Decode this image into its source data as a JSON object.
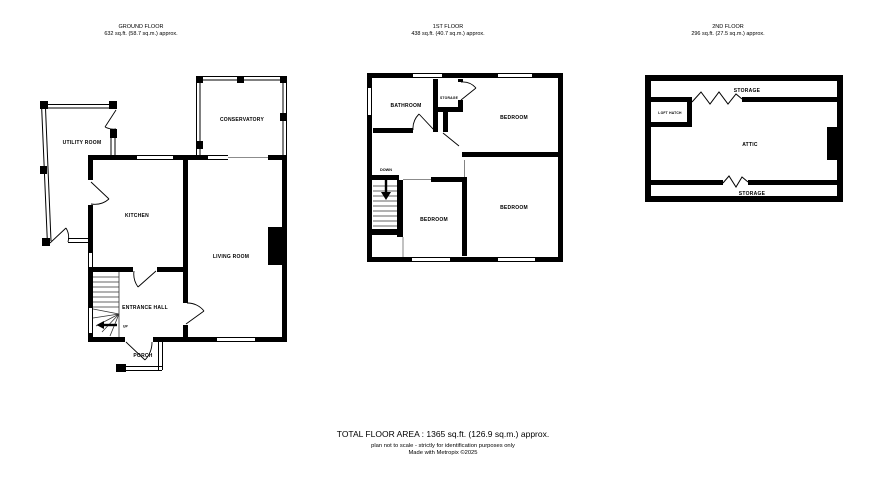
{
  "page": {
    "background": "#ffffff",
    "wall_color": "#000000"
  },
  "floors": [
    {
      "title": "GROUND FLOOR",
      "area": "632 sq.ft. (58.7 sq.m.) approx.",
      "rooms": [
        "UTILITY ROOM",
        "CONSERVATORY",
        "KITCHEN",
        "LIVING ROOM",
        "ENTRANCE HALL",
        "PORCH"
      ],
      "stair_label": "UP"
    },
    {
      "title": "1ST FLOOR",
      "area": "438 sq.ft. (40.7 sq.m.) approx.",
      "rooms": [
        "BATHROOM",
        "STORAGE",
        "BEDROOM",
        "BEDROOM",
        "BEDROOM"
      ],
      "stair_label": "DOWN"
    },
    {
      "title": "2ND FLOOR",
      "area": "296 sq.ft. (27.5 sq.m.) approx.",
      "rooms": [
        "STORAGE",
        "LOFT HATCH",
        "ATTIC",
        "STORAGE"
      ]
    }
  ],
  "footer": {
    "total_area": "TOTAL FLOOR AREA : 1365 sq.ft. (126.9 sq.m.) approx.",
    "disclaimer": "plan not to scale - strictly for identification purposes only",
    "credit": "Made with Metropix ©2025"
  }
}
